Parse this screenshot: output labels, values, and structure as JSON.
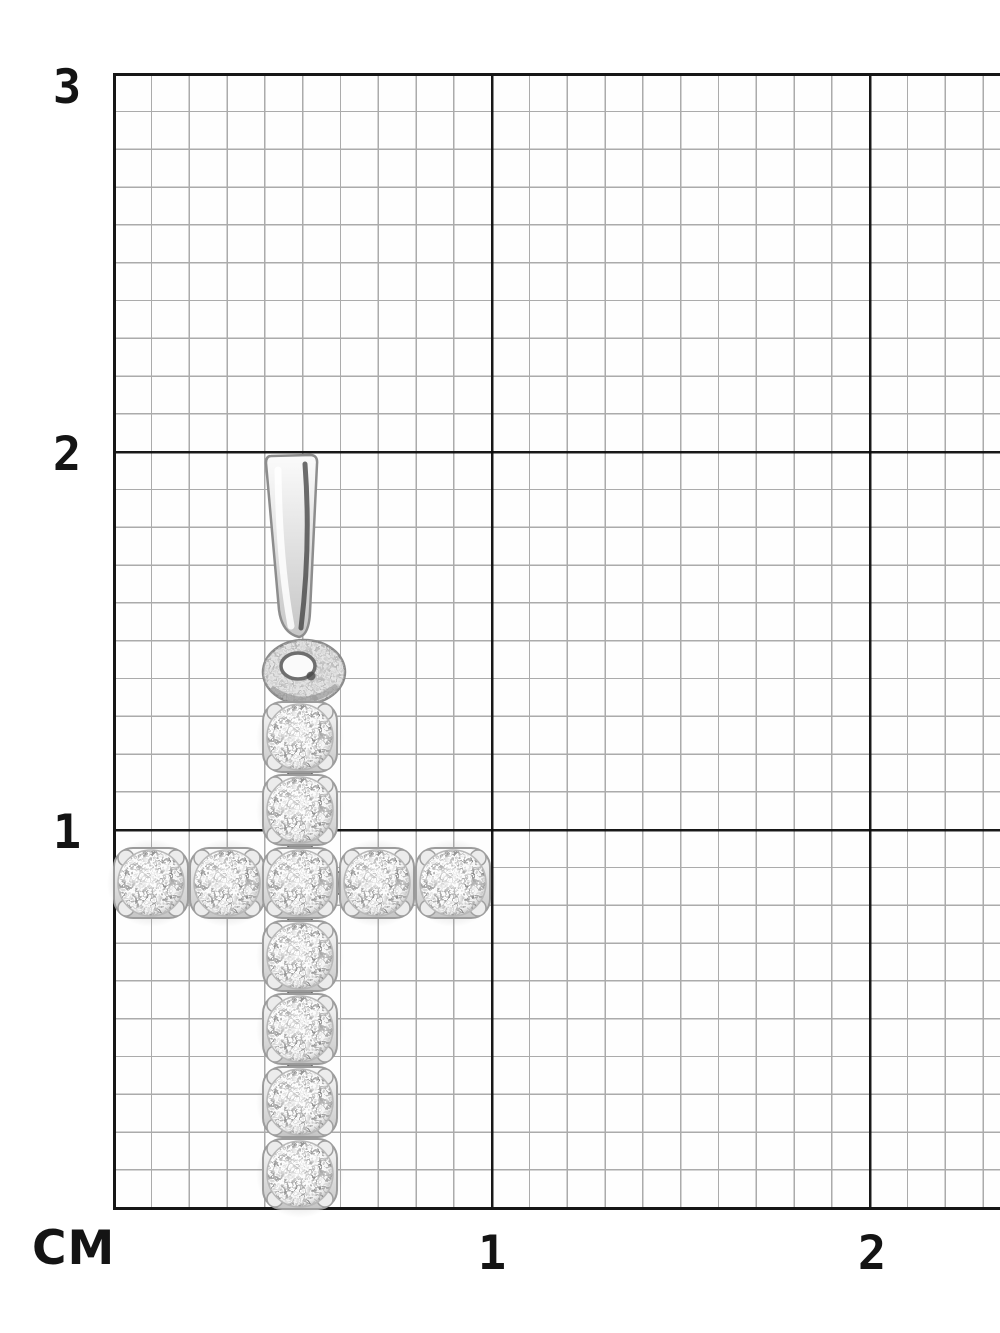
{
  "background_color": "#ffffff",
  "grid": {
    "unit_label": "СМ",
    "minor_line_color": "#ababab",
    "major_line_color": "#161616",
    "cell_size_mm": 1,
    "major_cell_size_cm": 1,
    "y_labels": [
      {
        "text": "3"
      },
      {
        "text": "2"
      },
      {
        "text": "1"
      }
    ],
    "x_labels": [
      {
        "text": "1"
      },
      {
        "text": "2"
      }
    ]
  },
  "pendant": {
    "name": "diamond-cross-pendant",
    "description": "White-metal cross pendant set with round brilliant diamonds, photographed on a centimeter grid",
    "vertical_stones": 7,
    "horizontal_stones": 5,
    "total_stones": 11,
    "metal_color": "#e6e6e6",
    "approx_width_cm": 1.0,
    "approx_height_cm": 2.0
  }
}
